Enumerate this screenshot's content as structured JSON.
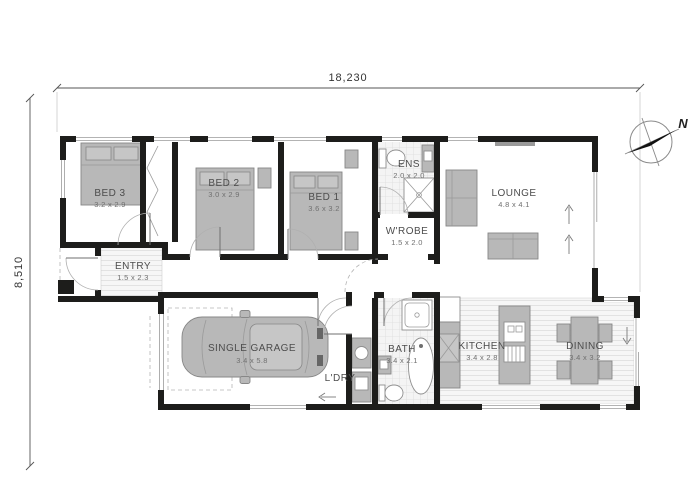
{
  "plan": {
    "dim_width": "18,230",
    "dim_height": "8,510",
    "compass": "N",
    "colors": {
      "wall": "#1d1d1b",
      "furniture": "#b8b8b8",
      "floor_stripe": "#e2e2e2",
      "tile": "#dcdcdc"
    },
    "rooms": {
      "bed3": {
        "name": "BED 3",
        "dims": "3.2 x 2.9"
      },
      "bed2": {
        "name": "BED 2",
        "dims": "3.0 x 2.9"
      },
      "bed1": {
        "name": "BED 1",
        "dims": "3.6 x 3.2"
      },
      "ens": {
        "name": "ENS",
        "dims": "2.0 x 2.0"
      },
      "wrobe": {
        "name": "W'ROBE",
        "dims": "1.5 x 2.0"
      },
      "entry": {
        "name": "ENTRY",
        "dims": "1.5 x 2.3"
      },
      "lounge": {
        "name": "LOUNGE",
        "dims": "4.8 x 4.1"
      },
      "garage": {
        "name": "SINGLE GARAGE",
        "dims": "3.4 x 5.8"
      },
      "ldry": {
        "name": "L'DRY",
        "dims": ""
      },
      "bath": {
        "name": "BATH",
        "dims": "3.4 x 2.1"
      },
      "kitchen": {
        "name": "KITCHEN",
        "dims": "3.4 x 2.8"
      },
      "dining": {
        "name": "DINING",
        "dims": "3.4 x 3.2"
      }
    }
  }
}
